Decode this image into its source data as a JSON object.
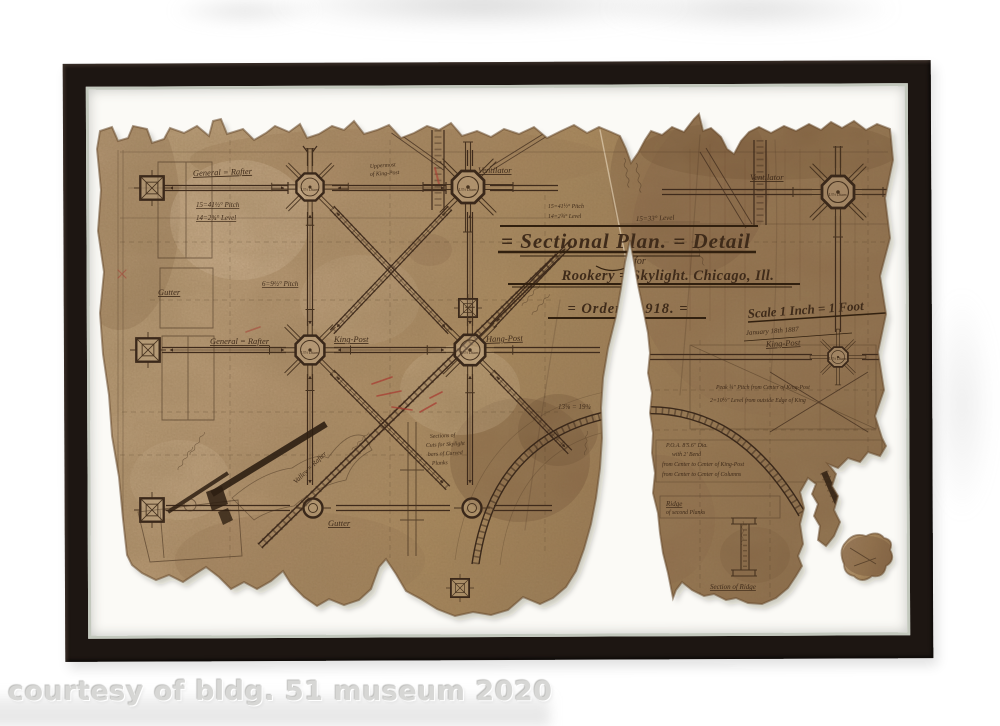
{
  "photo": {
    "watermark": "courtesy of bldg. 51 museum 2020"
  },
  "drawing": {
    "title": {
      "plan": "= Sectional Plan. = Detail",
      "for": "for",
      "subject": "Rookery = Skylight.  Chicago, Ill.",
      "order": "= Order  № 918. =",
      "scale": "Scale 1 Inch = 1 Foot",
      "date": "January 18th 1887"
    },
    "labels": {
      "general_rafter_top": "General = Rafter",
      "uppermost": "Uppermost",
      "of_king_post": "of King-Post",
      "ventilator_top": "Ventilator",
      "ventilator_right": "Ventilator",
      "level_right": "15=33° Level",
      "pitch_left": "15=41½° Pitch",
      "level_left": "14=2¾° Level",
      "gutter_left": "Gutter",
      "pitch_mid": "6=9½° Pitch",
      "general_rafter_mid": "General = Rafter",
      "king_post_mid": "King-Post",
      "hang_post": "Hang-Post",
      "king_post_right": "King-Post",
      "gutter_bottom": "Gutter",
      "valley": "Valley = Rafter",
      "ridge": "Ridge",
      "ridge_sub": "of second Planks",
      "section_ridge": "Section of Ridge",
      "dim_note": "13⅝ = 19¾",
      "note_pitch_right": "Peak ¾″ Pitch from Center of King-Post",
      "note_level_right": "2=10½″ Level from outside Edge of King",
      "note_arc_1": "P.O.A. 8′5.6″ Dia.",
      "note_arc_2": "with 2′ Bend",
      "note_arc_3": "from Center to Center of King-Post",
      "note_arc_4": "from Center to Center of Columns",
      "note_center_1": "Sections of",
      "note_center_2": "Cuts for Skylight",
      "note_center_3": "bars of Curved",
      "note_center_4": "Planks",
      "dim_left_1": "14=4¾ Pitch",
      "dim_left_2": "16=2½ Level",
      "hub_diam": "13½ Diam."
    },
    "colors": {
      "frame": "#1d1612",
      "mat": "#fbfaf6",
      "paper_light": "#c2a884",
      "paper_dark": "#8d6f4e",
      "ink": "#3f2b1a",
      "red_pencil": "#a83c32",
      "watermark": "#d7d7d5"
    }
  }
}
